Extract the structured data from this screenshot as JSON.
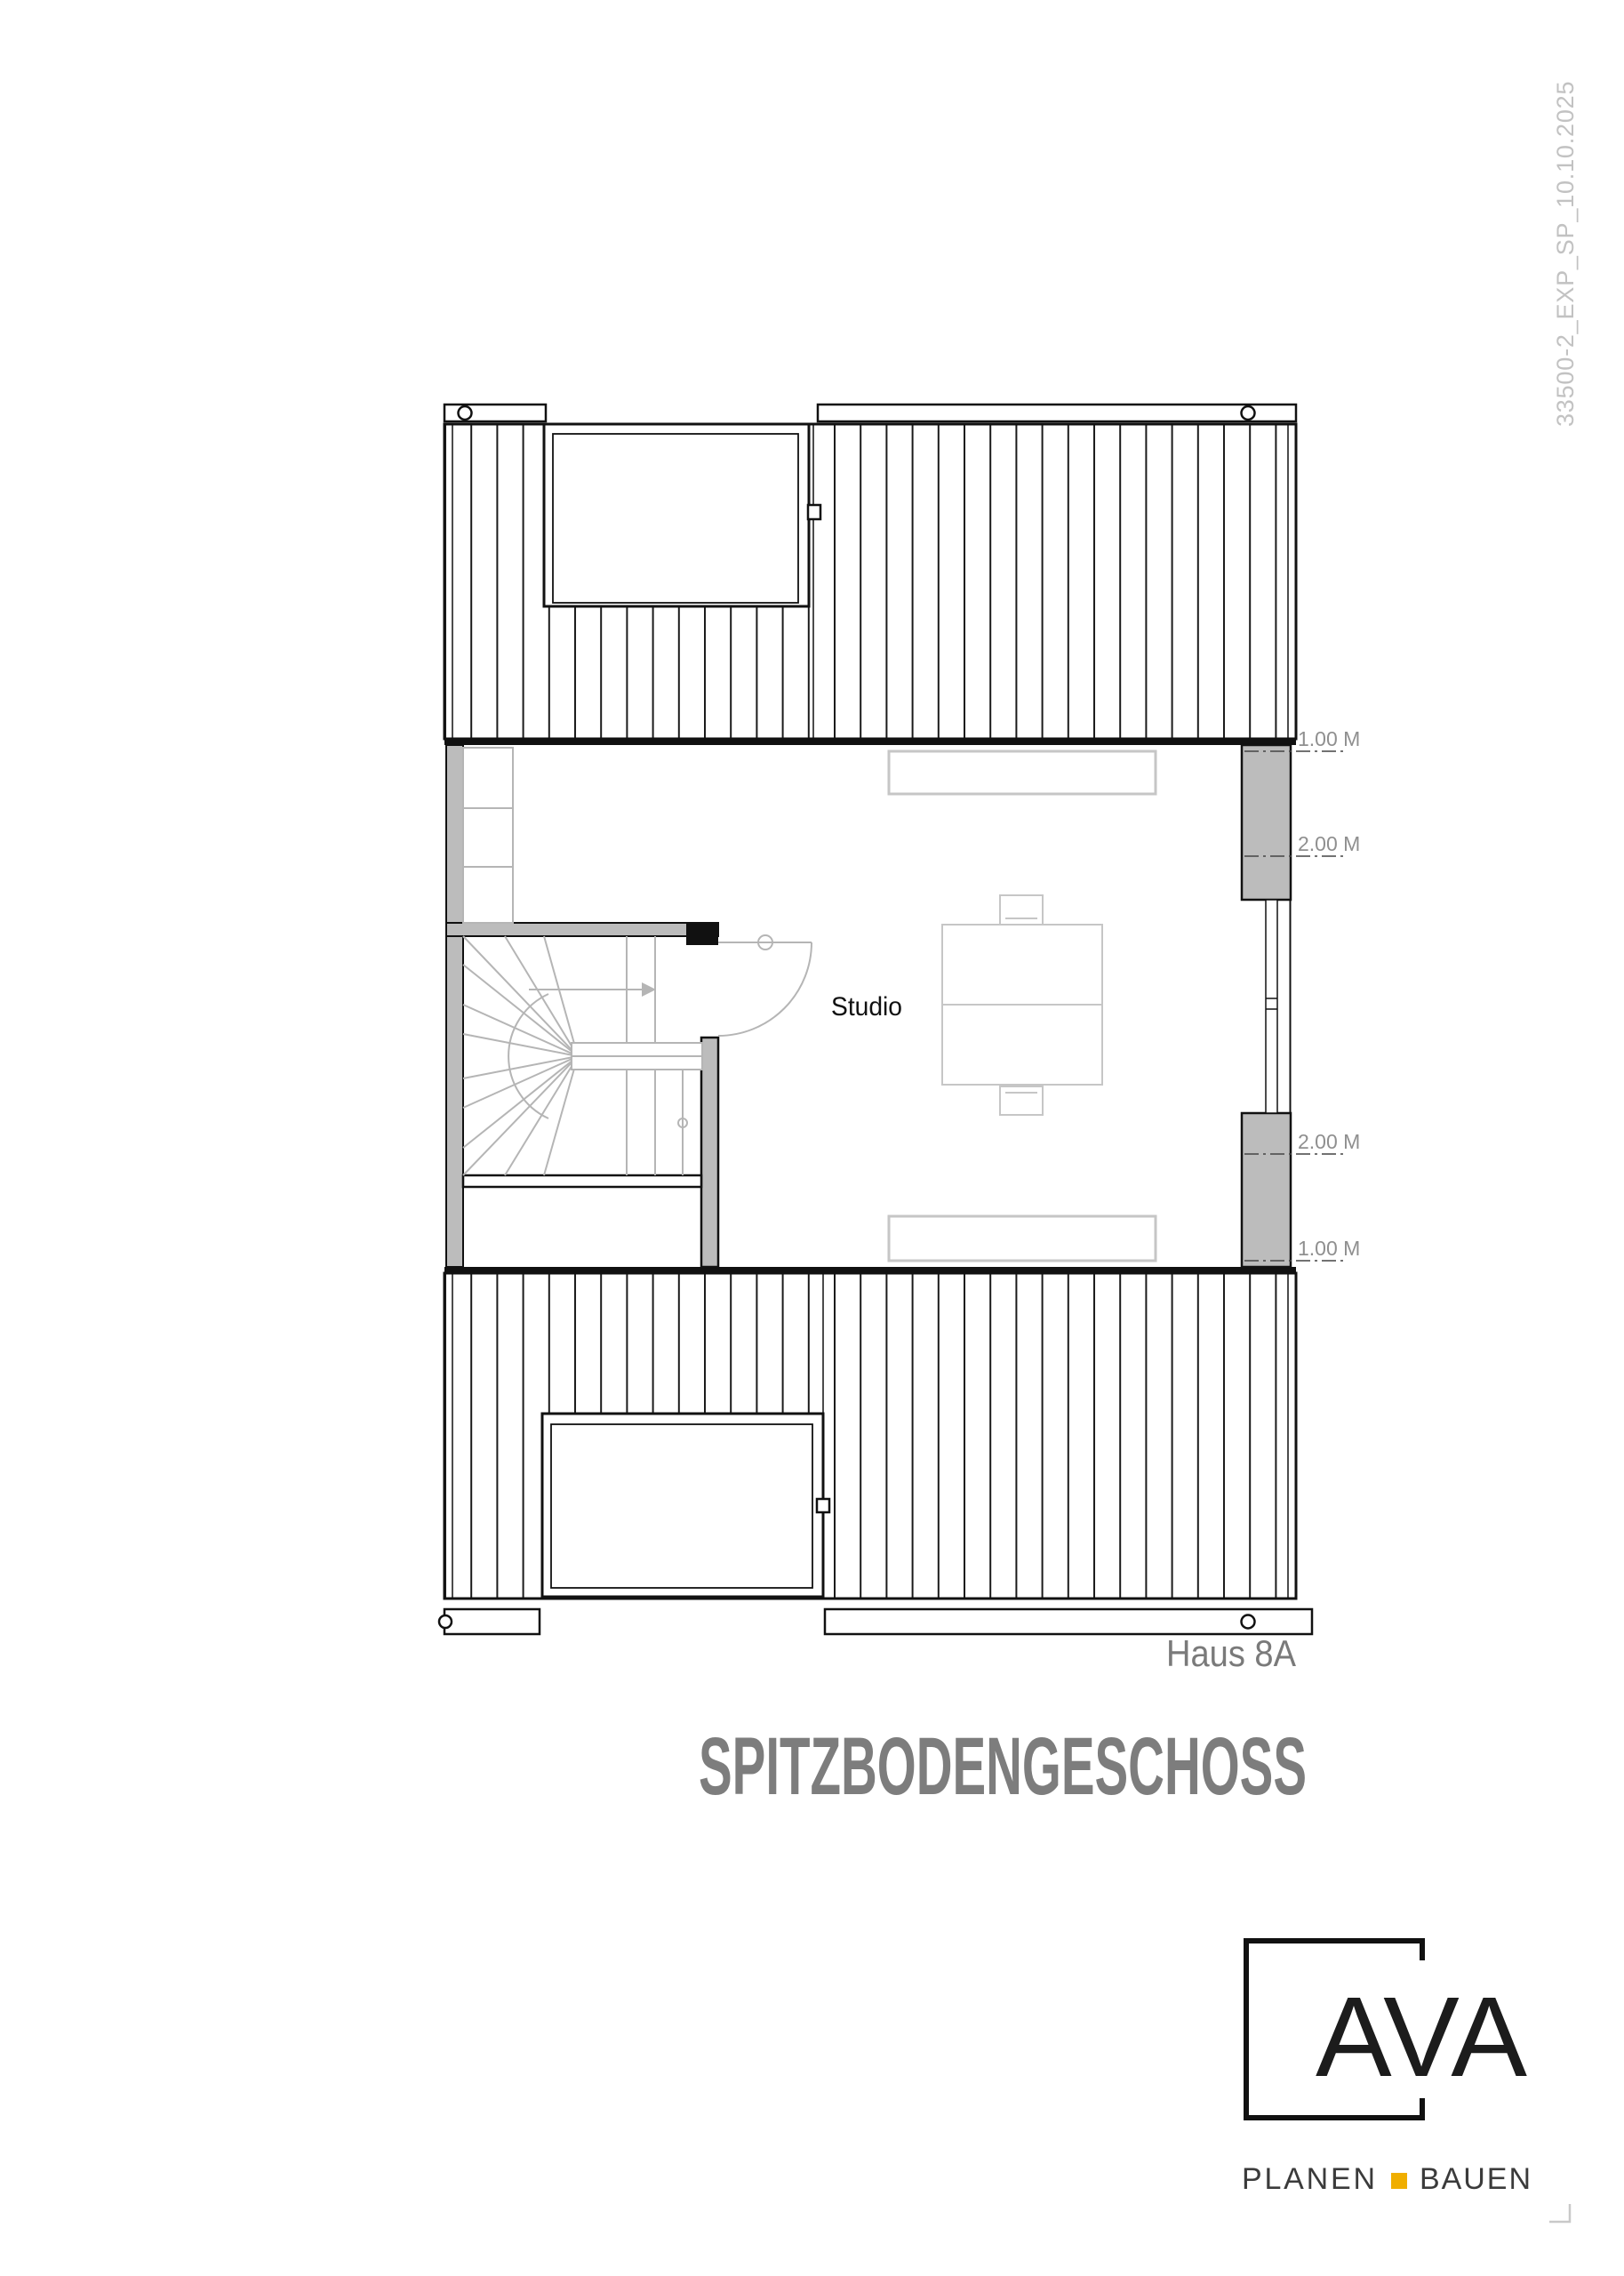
{
  "document": {
    "doc_ref_vertical": "33500-2_EXP_SP_10.10.2025",
    "house_label": "Haus 8A",
    "title": "SPITZBODENGESCHOSS"
  },
  "plan": {
    "room_label": "Studio",
    "dimension_markers": [
      {
        "label": "1.00 M"
      },
      {
        "label": "2.00 M"
      },
      {
        "label": "2.00 M"
      },
      {
        "label": "1.00 M"
      }
    ]
  },
  "logo": {
    "name": "AVA",
    "tagline_left": "PLANEN",
    "tagline_right": "BAUEN",
    "accent_color": "#f0ae00"
  },
  "colors": {
    "wall_fill": "#bcbcbc",
    "stair_line": "#b5b5b5",
    "furniture_line": "#c6c6c6",
    "dim_text": "#8f8f8f",
    "house_label_text": "#7a7a7a",
    "title_text": "#7d7d7d",
    "doc_ref_text": "#c2c2c2",
    "line_black": "#111111"
  }
}
